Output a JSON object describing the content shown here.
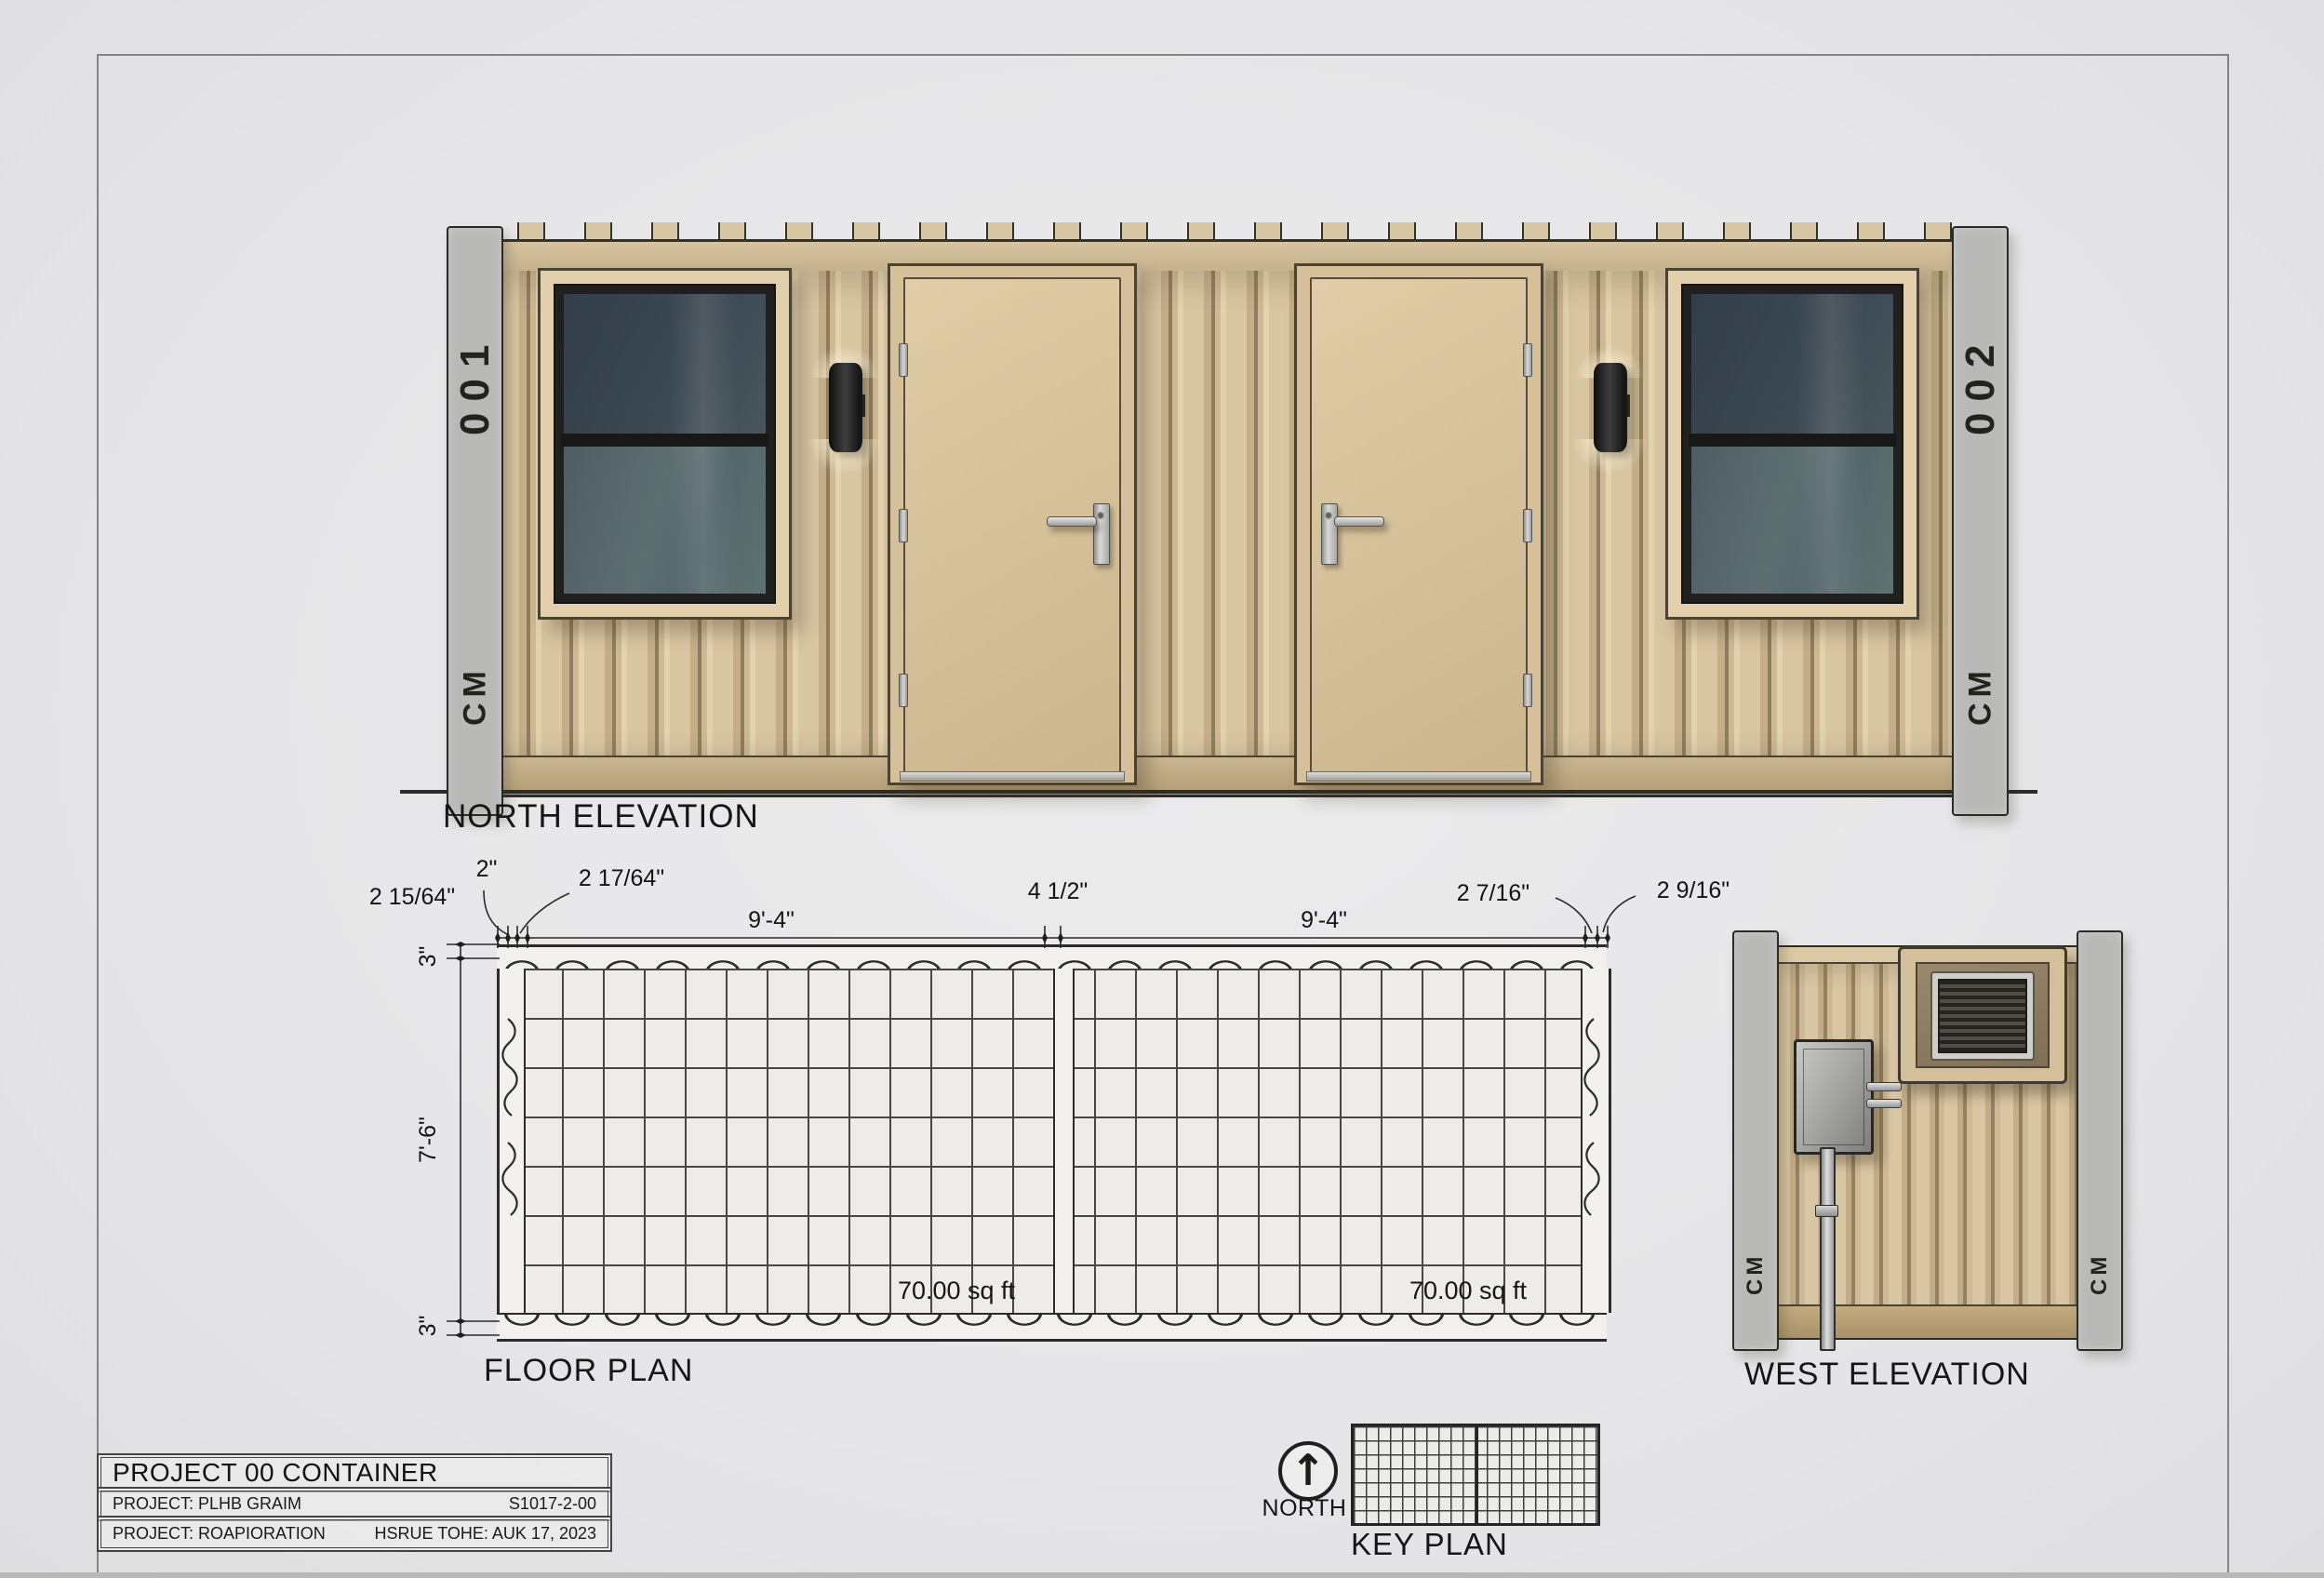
{
  "north_elevation": {
    "label": "NORTH ELEVATION",
    "left_post": {
      "top": "001",
      "bottom": "CM"
    },
    "right_post": {
      "top": "002",
      "bottom": "CM"
    }
  },
  "floor_plan": {
    "label": "FLOOR PLAN",
    "rooms": [
      {
        "area": "70.00 sq ft"
      },
      {
        "area": "70.00 sq ft"
      }
    ],
    "dims_top": [
      "2 15/64\"",
      "2\"",
      "2 17/64\"",
      "9'-4\"",
      "4 1/2\"",
      "9'-4\"",
      "2 7/16\"",
      "2 9/16\""
    ],
    "dims_left": [
      "3\"",
      "7'-6\"",
      "3\""
    ]
  },
  "west_elevation": {
    "label": "WEST ELEVATION",
    "left_post_bottom": "CM",
    "right_post_bottom": "CM"
  },
  "key_plan": {
    "label": "KEY PLAN",
    "north_label": "NORTH",
    "north_arrow_glyph": "↑"
  },
  "title_block": {
    "title": "PROJECT 00 CONTAINER",
    "rows": [
      {
        "left": "PROJECT:  PLHB GRAIM",
        "right": "S1017-2-00"
      },
      {
        "left": "PROJECT: ROAPIORATION",
        "right": "HSRUE TOHE: AUK 17, 2023"
      }
    ]
  },
  "colors": {
    "wall_tan": "#d2bd98",
    "rib_dark": "#8f7d5d",
    "post_silver": "#c4c4c2",
    "glass_top": "#3b4751",
    "glass_bottom": "#5d6e71",
    "linework": "#2c2c2a",
    "paper": "#e8e8e9"
  }
}
